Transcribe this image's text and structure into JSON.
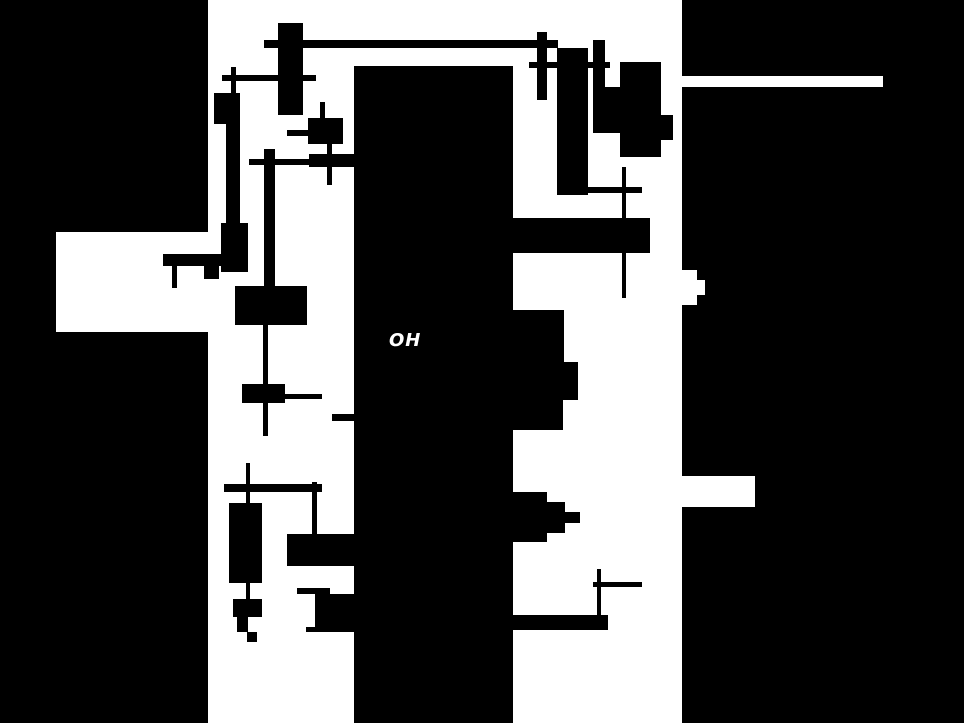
{
  "canvas": {
    "width": 964,
    "height": 723,
    "background": "#ffffff",
    "ink": "#000000"
  },
  "map": {
    "label": {
      "text": "OH",
      "x": 389,
      "y": 332,
      "font_size": 18,
      "color": "#ffffff"
    },
    "panels": [
      {
        "name": "left-black-panel",
        "x": 0,
        "y": 0,
        "w": 208,
        "h": 723
      },
      {
        "name": "central-black-bar",
        "x": 354,
        "y": 66,
        "w": 159,
        "h": 657
      },
      {
        "name": "right-black-panel",
        "x": 682,
        "y": 0,
        "w": 282,
        "h": 723
      }
    ],
    "cutouts": [
      {
        "name": "left-panel-notch",
        "x": 56,
        "y": 232,
        "w": 152,
        "h": 100
      },
      {
        "name": "right-panel-road-stripe",
        "x": 682,
        "y": 76,
        "w": 201,
        "h": 11
      },
      {
        "name": "right-panel-notch-a1",
        "x": 682,
        "y": 270,
        "w": 15,
        "h": 35
      },
      {
        "name": "right-panel-notch-a2",
        "x": 697,
        "y": 280,
        "w": 8,
        "h": 15
      },
      {
        "name": "right-panel-notch-b",
        "x": 682,
        "y": 476,
        "w": 73,
        "h": 31
      }
    ],
    "shapes": [
      {
        "name": "footprint-a-body",
        "x": 278,
        "y": 23,
        "w": 25,
        "h": 92
      },
      {
        "name": "road-a-horizontal",
        "x": 264,
        "y": 40,
        "w": 294,
        "h": 8
      },
      {
        "name": "road-b-vertical",
        "x": 231,
        "y": 67,
        "w": 5,
        "h": 26
      },
      {
        "name": "road-b-horizontal",
        "x": 222,
        "y": 75,
        "w": 94,
        "h": 6
      },
      {
        "name": "footprint-c1",
        "x": 214,
        "y": 93,
        "w": 26,
        "h": 31
      },
      {
        "name": "footprint-c1-bar",
        "x": 226,
        "y": 124,
        "w": 14,
        "h": 99
      },
      {
        "name": "footprint-c2",
        "x": 221,
        "y": 223,
        "w": 27,
        "h": 49
      },
      {
        "name": "footprint-c-hbar",
        "x": 163,
        "y": 254,
        "w": 58,
        "h": 12
      },
      {
        "name": "road-c-vertical",
        "x": 172,
        "y": 266,
        "w": 5,
        "h": 22
      },
      {
        "name": "footprint-c-small",
        "x": 204,
        "y": 265,
        "w": 15,
        "h": 14
      },
      {
        "name": "footprint-d",
        "x": 308,
        "y": 118,
        "w": 35,
        "h": 26
      },
      {
        "name": "road-d-horizontal",
        "x": 287,
        "y": 130,
        "w": 21,
        "h": 6
      },
      {
        "name": "road-d-vertical-up",
        "x": 320,
        "y": 102,
        "w": 5,
        "h": 16
      },
      {
        "name": "road-d-vertical-dn",
        "x": 327,
        "y": 144,
        "w": 5,
        "h": 41
      },
      {
        "name": "footprint-e",
        "x": 309,
        "y": 154,
        "w": 45,
        "h": 13
      },
      {
        "name": "road-e-horizontal",
        "x": 249,
        "y": 159,
        "w": 60,
        "h": 6
      },
      {
        "name": "footprint-f-bar",
        "x": 264,
        "y": 149,
        "w": 11,
        "h": 139
      },
      {
        "name": "footprint-f2",
        "x": 235,
        "y": 286,
        "w": 72,
        "h": 39
      },
      {
        "name": "road-f-vertical",
        "x": 263,
        "y": 325,
        "w": 5,
        "h": 111
      },
      {
        "name": "footprint-f3-body",
        "x": 242,
        "y": 384,
        "w": 43,
        "h": 19
      },
      {
        "name": "road-f3-horizontal",
        "x": 265,
        "y": 394,
        "w": 57,
        "h": 5
      },
      {
        "name": "road-g-horizontal",
        "x": 332,
        "y": 414,
        "w": 22,
        "h": 7
      },
      {
        "name": "road-h1-vertical",
        "x": 246,
        "y": 463,
        "w": 4,
        "h": 40
      },
      {
        "name": "road-h2-horizontal",
        "x": 224,
        "y": 484,
        "w": 98,
        "h": 8
      },
      {
        "name": "road-h3-vertical",
        "x": 312,
        "y": 482,
        "w": 5,
        "h": 53
      },
      {
        "name": "footprint-h4-body",
        "x": 229,
        "y": 503,
        "w": 33,
        "h": 80
      },
      {
        "name": "road-h4-vertical",
        "x": 246,
        "y": 583,
        "w": 4,
        "h": 19
      },
      {
        "name": "footprint-h5",
        "x": 233,
        "y": 599,
        "w": 29,
        "h": 18
      },
      {
        "name": "footprint-h6-step",
        "x": 237,
        "y": 617,
        "w": 11,
        "h": 15
      },
      {
        "name": "footprint-h7-tiny",
        "x": 247,
        "y": 632,
        "w": 10,
        "h": 10
      },
      {
        "name": "footprint-i",
        "x": 287,
        "y": 534,
        "w": 67,
        "h": 32
      },
      {
        "name": "footprint-j-thin",
        "x": 297,
        "y": 588,
        "w": 33,
        "h": 6
      },
      {
        "name": "footprint-j-main",
        "x": 315,
        "y": 594,
        "w": 39,
        "h": 38
      },
      {
        "name": "footprint-j-step",
        "x": 306,
        "y": 627,
        "w": 9,
        "h": 5
      },
      {
        "name": "footprint-k-vbar",
        "x": 537,
        "y": 32,
        "w": 10,
        "h": 68
      },
      {
        "name": "road-k-horizontal",
        "x": 529,
        "y": 62,
        "w": 81,
        "h": 6
      },
      {
        "name": "footprint-l-tall",
        "x": 557,
        "y": 48,
        "w": 31,
        "h": 147
      },
      {
        "name": "footprint-m-big",
        "x": 620,
        "y": 62,
        "w": 41,
        "h": 95
      },
      {
        "name": "footprint-m-left",
        "x": 593,
        "y": 87,
        "w": 27,
        "h": 46
      },
      {
        "name": "footprint-m-vbar",
        "x": 593,
        "y": 40,
        "w": 12,
        "h": 67
      },
      {
        "name": "footprint-m-bump",
        "x": 661,
        "y": 115,
        "w": 12,
        "h": 25
      },
      {
        "name": "road-n-vertical",
        "x": 622,
        "y": 167,
        "w": 4,
        "h": 131
      },
      {
        "name": "road-n-horizontal",
        "x": 588,
        "y": 187,
        "w": 54,
        "h": 6
      },
      {
        "name": "footprint-o-band",
        "x": 513,
        "y": 218,
        "w": 137,
        "h": 35
      },
      {
        "name": "footprint-p1",
        "x": 513,
        "y": 310,
        "w": 51,
        "h": 90
      },
      {
        "name": "footprint-p2",
        "x": 564,
        "y": 362,
        "w": 14,
        "h": 38
      },
      {
        "name": "footprint-p3",
        "x": 513,
        "y": 400,
        "w": 50,
        "h": 30
      },
      {
        "name": "footprint-q1",
        "x": 513,
        "y": 492,
        "w": 34,
        "h": 50
      },
      {
        "name": "footprint-q2",
        "x": 547,
        "y": 502,
        "w": 18,
        "h": 31
      },
      {
        "name": "footprint-q3",
        "x": 565,
        "y": 512,
        "w": 15,
        "h": 11
      },
      {
        "name": "road-r-vertical",
        "x": 597,
        "y": 569,
        "w": 4,
        "h": 48
      },
      {
        "name": "road-r-horizontal",
        "x": 593,
        "y": 582,
        "w": 49,
        "h": 5
      },
      {
        "name": "footprint-s-bar",
        "x": 513,
        "y": 615,
        "w": 95,
        "h": 15
      }
    ]
  }
}
